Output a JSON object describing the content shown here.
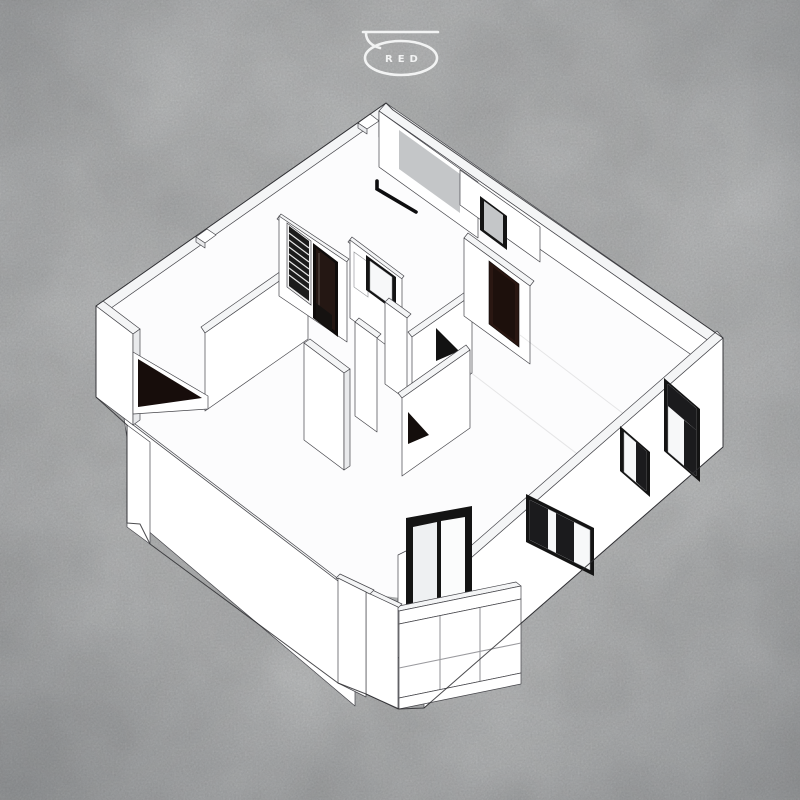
{
  "logo": {
    "text": "RED"
  },
  "colors": {
    "background": "#c6c8c9",
    "wall_white": "#ffffff",
    "wall_top": "#f4f5f6",
    "wall_shade": "#e9eaec",
    "floor_white": "#fcfcfd",
    "line": "#45454a",
    "frame_black": "#141414",
    "door_dark": "#2a1712",
    "glass_gray": "#c4c6c8",
    "glass_white": "#f7f8f9",
    "logo_white": "#f2f3f3"
  }
}
